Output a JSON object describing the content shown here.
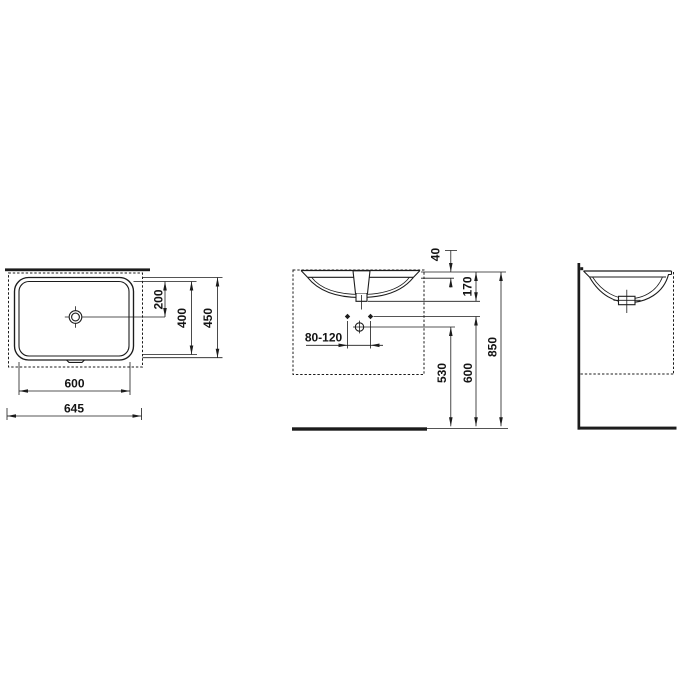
{
  "colors": {
    "line": "#1c1c1c",
    "background": "#ffffff"
  },
  "dimensions": {
    "top_view": {
      "d200": "200",
      "d400": "400",
      "d450": "450",
      "d600": "600",
      "d645": "645"
    },
    "front_view": {
      "d40": "40",
      "d170": "170",
      "d80_120": "80-120",
      "d530": "530",
      "d600": "600",
      "d850": "850"
    }
  }
}
